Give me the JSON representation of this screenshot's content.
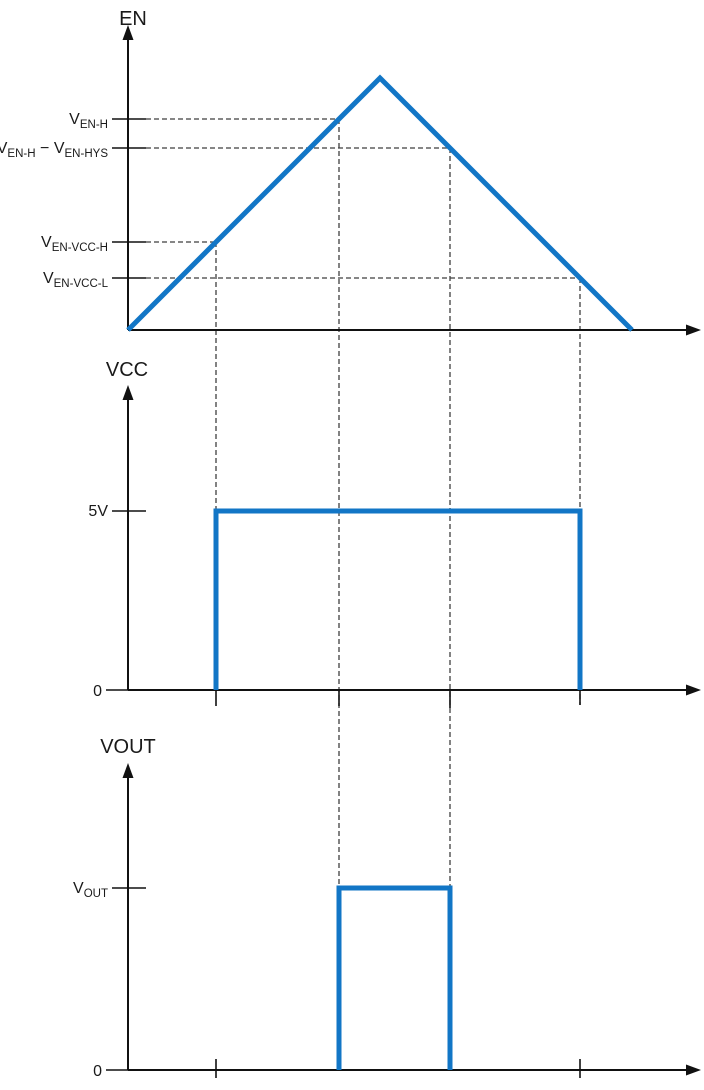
{
  "figure": {
    "width": 704,
    "height": 1090,
    "colors": {
      "waveform": "#1276c6",
      "axis": "#111111",
      "dash": "#3f3f3f",
      "text": "#1a1a1a"
    },
    "stroke": {
      "waveform_width": 5,
      "axis_width": 2,
      "tick_width": 1.6,
      "dash_width": 1.3,
      "dash_pattern": "5 3"
    }
  },
  "chart_data": {
    "type": "line",
    "title": "EN / VCC / VOUT enable-hysteresis timing diagram",
    "panels": [
      {
        "id": "en",
        "title": "EN",
        "title_x": 133,
        "title_y": 25,
        "y_axis": {
          "x": 128,
          "bottom": 330,
          "tip": 25
        },
        "x_axis": {
          "y": 330,
          "left": 128,
          "tip": 701
        },
        "waveform": [
          [
            128,
            330
          ],
          [
            380,
            78
          ],
          [
            632,
            330
          ]
        ],
        "levels": [
          {
            "label": "V_{EN-H}",
            "y": 119,
            "dash_end_x": 339
          },
          {
            "label": "V_{EN-H} − V_{EN-HYS}",
            "y": 148,
            "dash_end_x": 450
          },
          {
            "label": "V_{EN-VCC-H}",
            "y": 242,
            "dash_end_x": 216
          },
          {
            "label": "V_{EN-VCC-L}",
            "y": 278,
            "dash_end_x": 580
          }
        ],
        "zero_label": null,
        "event_ticks": []
      },
      {
        "id": "vcc",
        "title": "VCC",
        "title_x": 127,
        "title_y": 376,
        "y_axis": {
          "x": 128,
          "bottom": 690,
          "tip": 385
        },
        "x_axis": {
          "y": 690,
          "left": 128,
          "tip": 701
        },
        "waveform": [
          [
            216,
            690
          ],
          [
            216,
            511
          ],
          [
            580,
            511
          ],
          [
            580,
            690
          ]
        ],
        "levels": [
          {
            "label": "5V",
            "y": 511,
            "dash_end_x": null
          }
        ],
        "zero_label": {
          "label": "0"
        },
        "event_ticks": [
          {
            "x": 216,
            "y1": 690,
            "y2": 706
          },
          {
            "x": 339,
            "y1": 690,
            "y2": 706
          },
          {
            "x": 450,
            "y1": 690,
            "y2": 708
          },
          {
            "x": 580,
            "y1": 690,
            "y2": 705
          }
        ]
      },
      {
        "id": "vout",
        "title": "VOUT",
        "title_x": 128,
        "title_y": 753,
        "y_axis": {
          "x": 128,
          "bottom": 1070,
          "tip": 763
        },
        "x_axis": {
          "y": 1070,
          "left": 128,
          "tip": 701
        },
        "waveform": [
          [
            339,
            1070
          ],
          [
            339,
            888
          ],
          [
            450,
            888
          ],
          [
            450,
            1070
          ]
        ],
        "levels": [
          {
            "label": "V_{OUT}",
            "y": 888,
            "dash_end_x": null
          }
        ],
        "zero_label": {
          "label": "0"
        },
        "event_ticks": [
          {
            "x": 216,
            "y1": 1059,
            "y2": 1078
          },
          {
            "x": 580,
            "y1": 1059,
            "y2": 1078
          }
        ]
      }
    ],
    "connectors": [
      {
        "x": 216,
        "y1": 242,
        "y2": 511
      },
      {
        "x": 339,
        "y1": 119,
        "y2": 888
      },
      {
        "x": 450,
        "y1": 148,
        "y2": 888
      },
      {
        "x": 580,
        "y1": 278,
        "y2": 705
      }
    ]
  }
}
